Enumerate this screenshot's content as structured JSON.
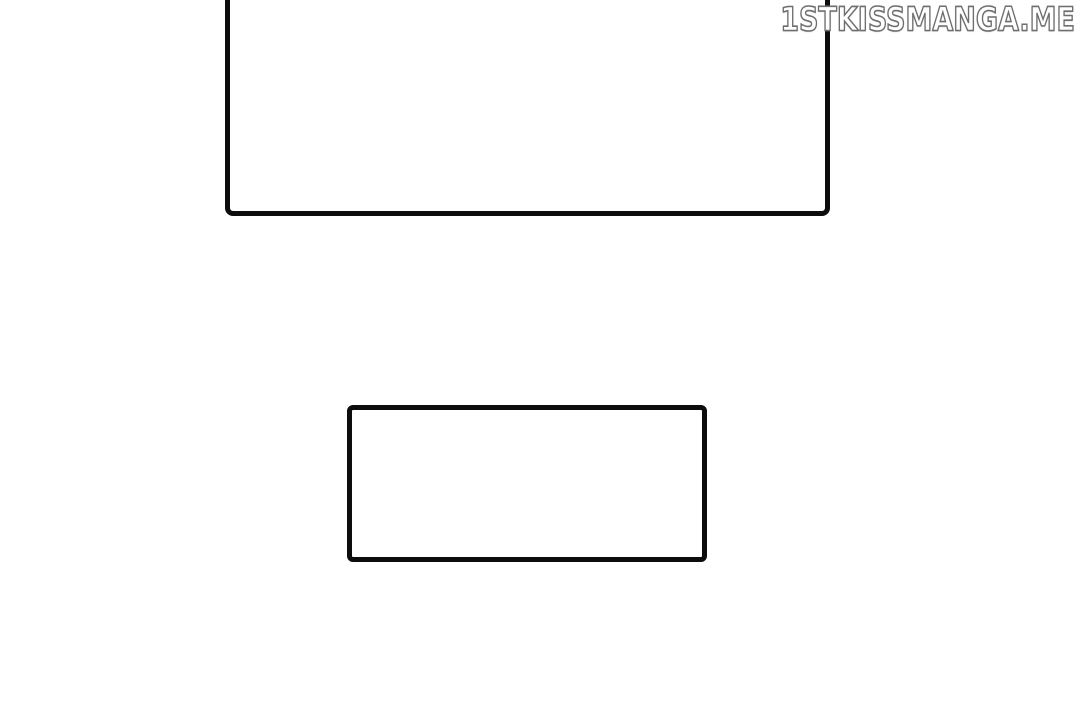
{
  "watermark": {
    "text": "1STKISSMANGA.ME"
  },
  "colors": {
    "background": "#ffffff",
    "panel_border": "#0d0d0d",
    "watermark_fill": "#ffffff",
    "watermark_outline": "#6e6e6e"
  },
  "panels": [
    {
      "id": "top-panel",
      "content": ""
    },
    {
      "id": "bottom-panel",
      "content": ""
    }
  ]
}
